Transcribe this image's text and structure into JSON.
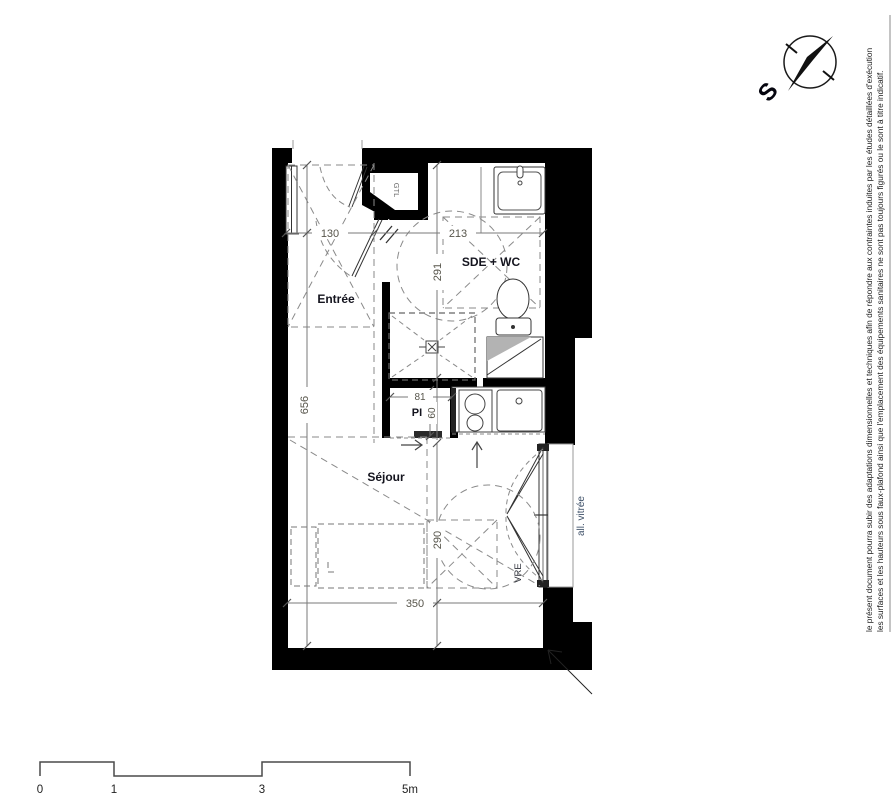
{
  "compass": {
    "south_label": "S"
  },
  "rooms": {
    "entree": "Entrée",
    "sde_wc": "SDE + WC",
    "sejour": "Séjour",
    "closet": "PI"
  },
  "annotations": {
    "gtl": "GTL",
    "vre": "VRE",
    "glazed_sill": "all. vitrée"
  },
  "dimensions": {
    "entree_width": "130",
    "sde_width": "213",
    "sde_height": "291",
    "total_height": "656",
    "closet_width": "81",
    "closet_depth": "60",
    "sejour_height": "290",
    "sejour_width": "350"
  },
  "scale_bar": {
    "labels": [
      "0",
      "1",
      "3",
      "5m"
    ]
  },
  "disclaimer": {
    "line1": "le présent document pourra subir des adaptations dimensionnelles et techniques afin de répondre aux contraintes induites par les études détaillées d'exécution",
    "line2": "les surfaces et les hauteurs sous faux-plafond ainsi que l'emplacement des équipements sanitaires ne sont pas toujours figurés ou le sont à titre indicatif."
  },
  "colors": {
    "wall": "#000000",
    "dimension_text": "#57554b",
    "room_label": "#14141e",
    "glazed_sill_text": "#3e5068",
    "dashed_line": "#8a8a8a"
  }
}
